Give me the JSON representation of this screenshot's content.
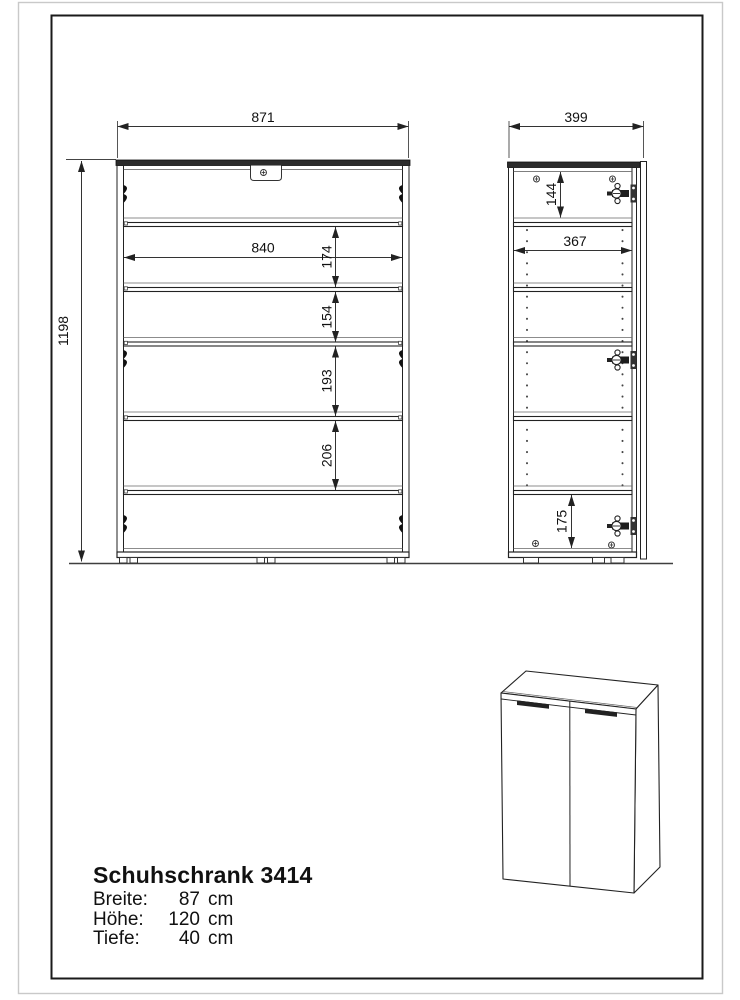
{
  "product": {
    "title": "Schuhschrank 3414",
    "specs": [
      {
        "label": "Breite:",
        "value": "87",
        "unit": "cm"
      },
      {
        "label": "Höhe:",
        "value": "120",
        "unit": "cm"
      },
      {
        "label": "Tiefe:",
        "value": "40",
        "unit": "cm"
      }
    ]
  },
  "front_view": {
    "dims": {
      "width": "871",
      "height": "1198",
      "inner_width": "840",
      "gap_1": "174",
      "gap_2": "154",
      "gap_3": "193",
      "gap_4": "206"
    }
  },
  "side_view": {
    "dims": {
      "depth": "399",
      "top_gap": "144",
      "inner_depth": "367",
      "bottom_gap": "175"
    }
  },
  "colors": {
    "line": "#222222",
    "panel_fill": "#2b2b2b",
    "frame": "#1a1a1a",
    "outer_border": "#c9c9c9"
  }
}
